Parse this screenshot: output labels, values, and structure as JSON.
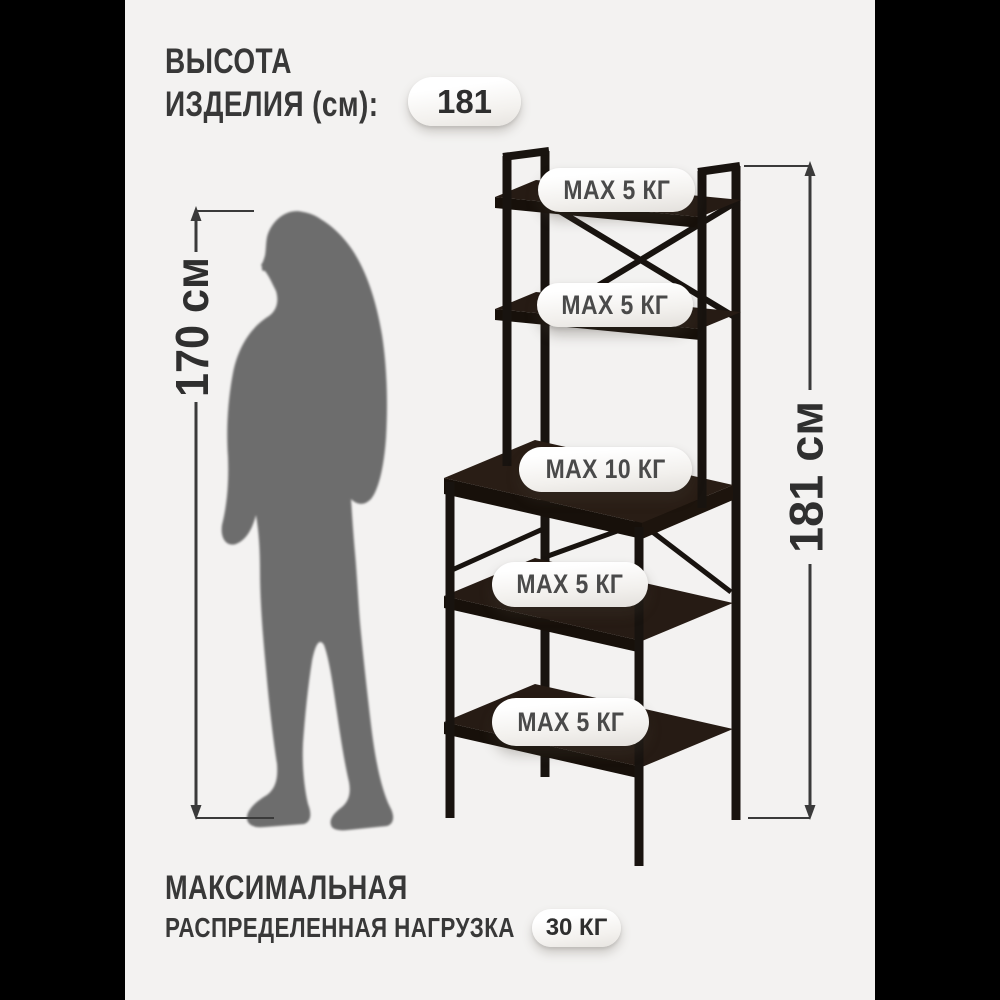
{
  "colors": {
    "outer_background": "#000000",
    "content_background": "#f3f2f1",
    "heading_text": "#383838",
    "dimension_text": "#2f2f2f",
    "pill_text": "#4a4a4a",
    "rack_frame": "#18130f",
    "rack_board_top": "#261b14",
    "rack_board_edge": "#17100a",
    "silhouette": "#6d6d6d"
  },
  "header": {
    "line1": "ВЫСОТА",
    "line2": "ИЗДЕЛИЯ (см):",
    "badge": "181"
  },
  "person": {
    "dimension_label": "170 см"
  },
  "rack": {
    "dimension_label": "181 см",
    "shelf_load_labels": [
      "MAX 5 КГ",
      "MAX 5 КГ",
      "MAX 10 КГ",
      "MAX 5 КГ",
      "MAX 5 КГ"
    ]
  },
  "footer": {
    "line1": "МАКСИМАЛЬНАЯ",
    "line2": "РАСПРЕДЕЛЕННАЯ НАГРУЗКА",
    "badge": "30 КГ"
  }
}
